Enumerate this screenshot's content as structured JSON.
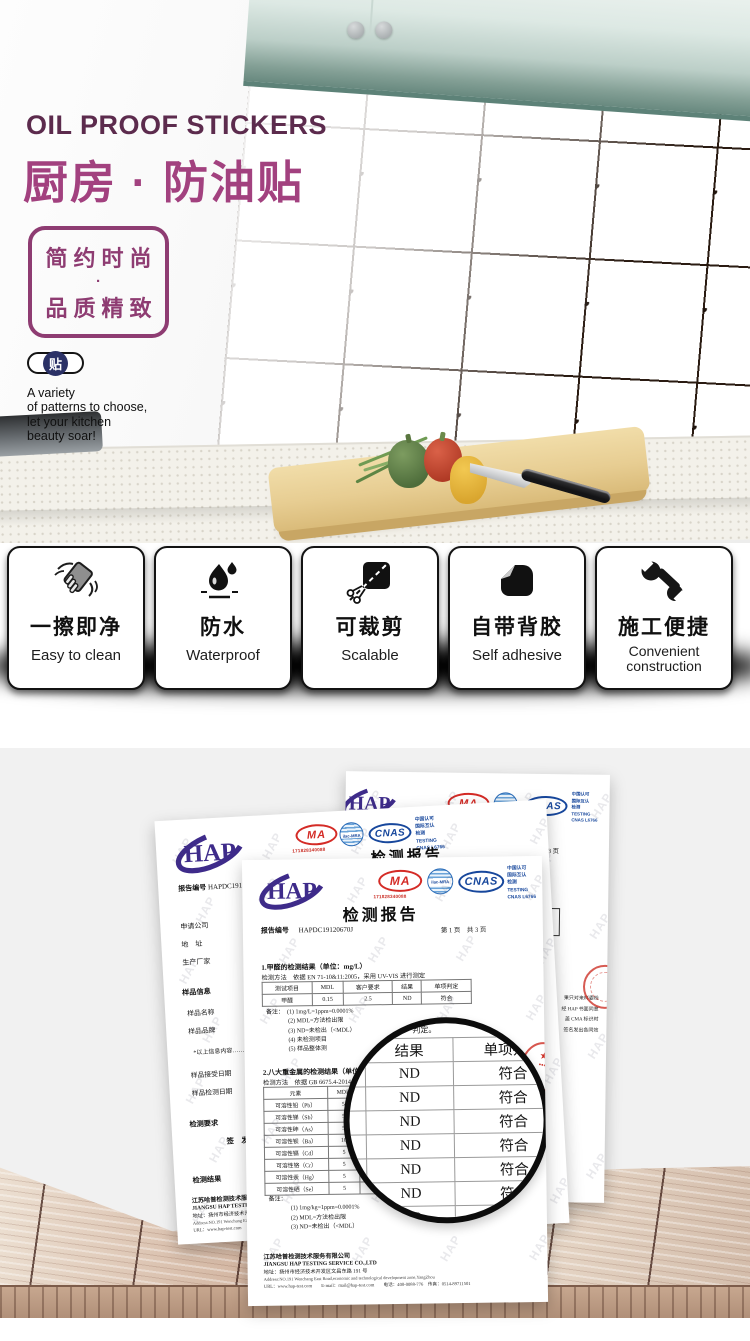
{
  "hero": {
    "title_en": "OIL PROOF STICKERS",
    "title_zh": "厨房 · 防油贴",
    "slogan_line1": "简约时尚",
    "slogan_dot": "·",
    "slogan_line2": "品质精致",
    "badge": "贴",
    "tagline_lines": [
      "A variety",
      "of patterns to choose,",
      "let your kitchen",
      "beauty soar!"
    ],
    "colors": {
      "title_en": "#5c2b4d",
      "title_zh": "#a2417f",
      "slogan_box": "#8e3c72",
      "badge_navy": "#2b3166"
    }
  },
  "features": [
    {
      "zh": "一擦即净",
      "en": "Easy to clean",
      "icon": "sponge-wipe-icon"
    },
    {
      "zh": "防水",
      "en": "Waterproof",
      "icon": "water-drop-icon"
    },
    {
      "zh": "可裁剪",
      "en": "Scalable",
      "icon": "scissors-cut-icon"
    },
    {
      "zh": "自带背胶",
      "en": "Self adhesive",
      "icon": "sticker-peel-icon"
    },
    {
      "zh": "施工便捷",
      "en_lines": [
        "Convenient",
        "construction"
      ],
      "icon": "wrench-icon"
    }
  ],
  "certificates": {
    "watermark": "HAP",
    "lab_logo": "HAP",
    "cma_label": "MA",
    "cma_number": "171828340088",
    "ilac_label": "ilac-MRA",
    "cnas_label": "CNAS",
    "accreditation_lines": [
      "中国认可",
      "国际互认",
      "检测",
      "TESTING",
      "CNAS L6766"
    ],
    "report_title": "检测报告",
    "report_no_label": "报告编号",
    "report_no": "HAPDC19120670J",
    "page_info": "第 1 页　共 3 页",
    "colors": {
      "hap_purple": "#3e2b8a",
      "cma_red": "#d42b26",
      "cnas_blue": "#17479c",
      "stamp_red": "#cc2d23"
    },
    "front": {
      "section1_title": "1.甲醛的检测结果（单位：mg/L）",
      "method1": "检测方法　依据 EN 71-10&11:2005，采用 UV-VIS 进行测定",
      "table1_headers": [
        "测试项目",
        "MDL",
        "客户要求",
        "结果",
        "单项判定"
      ],
      "table1_row": [
        "甲醛",
        "0.15",
        "2.5",
        "ND",
        "符合"
      ],
      "notes1": [
        "备注：　(1) 1mg/L=1ppm=0.0001%",
        "(2) MDL=方法检出限",
        "(3) ND=未检出（<MDL）",
        "(4) 未检测项目",
        "(5) 样品整体测"
      ],
      "section2_title": "2.八大重金属的检测结果（单位：mg/kg）",
      "method2": "检测方法　依据 GB 6675.4-2014，采用……",
      "table2_headers": [
        "元素",
        "MDL",
        "客户要求"
      ],
      "table2_rows": [
        [
          "可溶性铅（Pb）",
          "5"
        ],
        [
          "可溶性锑（Sb）",
          "5"
        ],
        [
          "可溶性砷（As）",
          "5"
        ],
        [
          "可溶性钡（Ba）",
          "10"
        ],
        [
          "可溶性镉（Cd）",
          "5"
        ],
        [
          "可溶性铬（Cr）",
          "5"
        ],
        [
          "可溶性汞（Hg）",
          "5"
        ],
        [
          "可溶性硒（Se）",
          "5"
        ]
      ],
      "notes2": [
        "备注：",
        "(1) 1mg/kg=1ppm=0.0001%",
        "(2) MDL=方法检出限",
        "(3) ND=未检出（<MDL）"
      ],
      "footer_lines": [
        "江苏哈普检测技术服务有限公司",
        "JIANGSU HAP TESTING SERVICE CO.,LTD",
        "地址：扬州市经济技术开发区文昌东路 191 号",
        "Address:NO.191 Wenchang East Road,economic and technological development zone,YangZhou",
        "URL：www.hap-test.com　　E-mail：mail@hap-test.com　　电话：400-0088-776　传真：0514-89711501"
      ]
    },
    "lens": {
      "fragment": "判定。",
      "headers": [
        "结果",
        "单项判定"
      ],
      "result": "ND",
      "verdict": "符合",
      "row_count": 8
    },
    "middle": {
      "field_labels": [
        "报告编号",
        "申请公司",
        "地　址",
        "生产厂家"
      ],
      "sample_header": "样品信息",
      "sample_labels": [
        "样品名称",
        "样品品牌"
      ],
      "sample_note": "*以上信息内容……",
      "date_labels": [
        "样品接受日期",
        "样品检测日期"
      ],
      "requirement_header": "检测要求",
      "result_header": "检测结果",
      "sign_label": "签　发"
    },
    "back": {
      "disclaimer_lines": [
        "果只对来样委检",
        "经 HAP 书面同意",
        "盖 CMA 标识时",
        "签名发出各同效"
      ]
    }
  }
}
